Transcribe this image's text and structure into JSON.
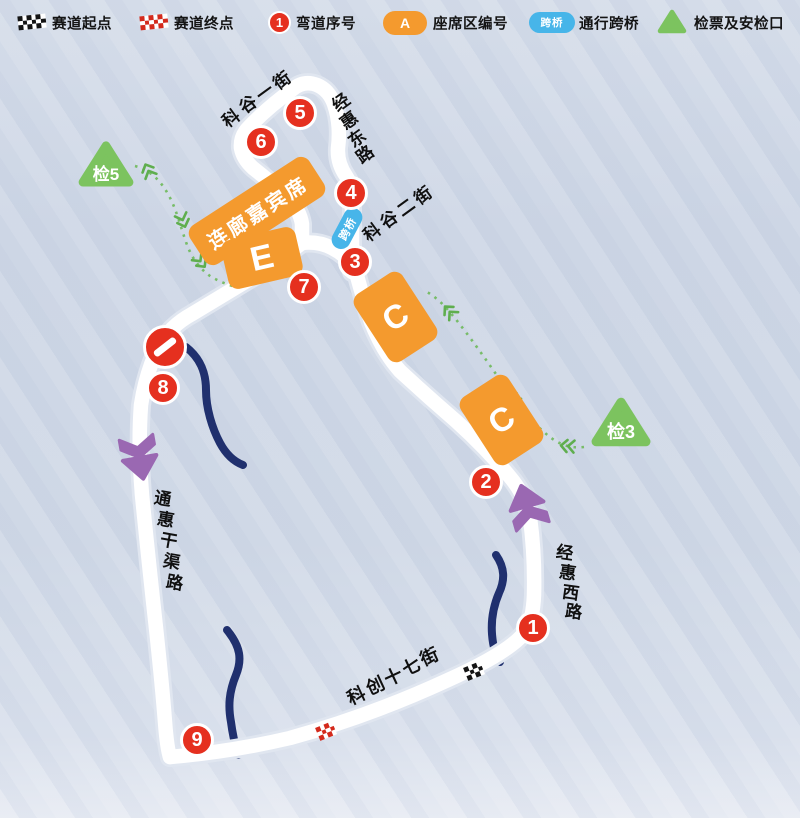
{
  "legend": {
    "items": [
      {
        "id": "start",
        "icon": "checkered-flag-black-icon",
        "label": "赛道起点"
      },
      {
        "id": "finish",
        "icon": "checkered-flag-red-icon",
        "label": "赛道终点"
      },
      {
        "id": "corner",
        "icon": "corner-number-badge-icon",
        "icon_text": "1",
        "label": "弯道序号"
      },
      {
        "id": "seat",
        "icon": "seat-area-badge-icon",
        "icon_text": "A",
        "label": "座席区编号"
      },
      {
        "id": "bridge",
        "icon": "bridge-badge-icon",
        "icon_text": "跨桥",
        "label": "通行跨桥"
      },
      {
        "id": "checkpoint",
        "icon": "checkpoint-triangle-icon",
        "label": "检票及安检口"
      }
    ]
  },
  "map": {
    "corners": [
      "1",
      "2",
      "3",
      "4",
      "5",
      "6",
      "7",
      "8",
      "9"
    ],
    "seat_areas": [
      {
        "id": "lounge",
        "label": "连廊嘉宾席"
      },
      {
        "id": "E",
        "label": "E"
      },
      {
        "id": "C1",
        "label": "C"
      },
      {
        "id": "C2",
        "label": "C"
      }
    ],
    "checkpoints": [
      {
        "id": "jian5",
        "label": "检5"
      },
      {
        "id": "jian3",
        "label": "检3"
      }
    ],
    "bridge_badge": "跨桥",
    "streets": [
      {
        "id": "kegu1",
        "name": "科谷一街"
      },
      {
        "id": "jinghui-east",
        "name": "经惠东路"
      },
      {
        "id": "kegu2",
        "name": "科谷二街"
      },
      {
        "id": "jinghui-west",
        "name": "经惠西路"
      },
      {
        "id": "tonghui",
        "name": "通惠干渠路"
      },
      {
        "id": "kechuang17",
        "name": "科创十七街"
      }
    ],
    "flags": [
      {
        "id": "start",
        "color_scheme": "black"
      },
      {
        "id": "finish",
        "color_scheme": "red"
      }
    ],
    "no_entry_sign": true,
    "route_arrows": 2
  },
  "colors": {
    "corner_red": "#e5301f",
    "seat_orange": "#f49a2e",
    "checkpoint_green": "#7cc35f",
    "bridge_blue": "#47b5e9",
    "route_purple": "#9a68b2",
    "river_navy": "#20306e",
    "road_white": "#ffffff",
    "walk_path_green": "#6eb95a",
    "background": "#cfd8e6",
    "label_text": "#141414"
  }
}
